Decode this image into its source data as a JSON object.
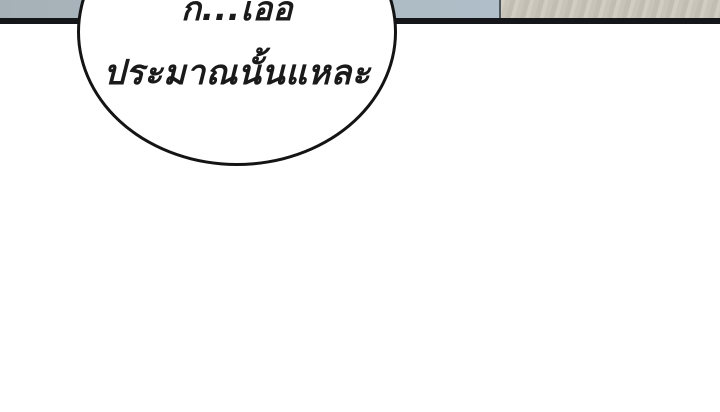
{
  "page": {
    "width": 720,
    "height": 412,
    "kind": "webtoon-panel-gutter"
  },
  "theme": {
    "page_bg": "#ffffff",
    "strip_blue_a": "#a6b1b7",
    "strip_blue_b": "#afbec8",
    "strip_divider": "#4f565e",
    "strip_beige_a": "#c9c4ba",
    "strip_beige_b": "#d2cdc3",
    "strip_beige_c": "#c2bdb2",
    "panel_border": "#15161a",
    "bubble_fill": "#ffffff",
    "bubble_outline": "#141414",
    "text_color": "#1a1a1a"
  },
  "speech_bubble": {
    "line1": "ก...เออ",
    "line2": "ประมาณนั้นแหละ"
  }
}
